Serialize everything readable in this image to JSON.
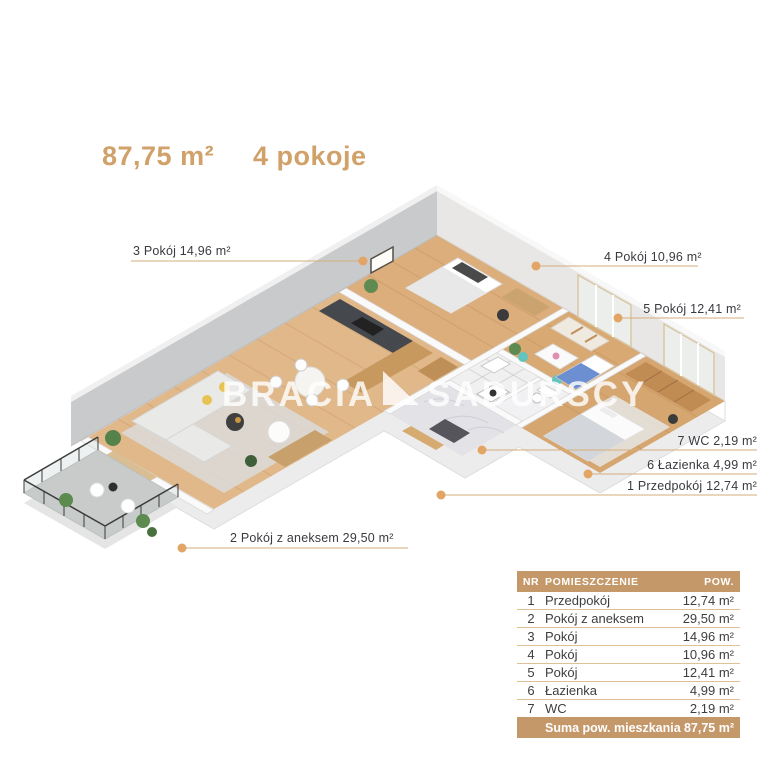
{
  "title": {
    "area": "87,75 m²",
    "rooms": "4 pokoje"
  },
  "watermark": {
    "left": "BRACIA",
    "right": "SADURSCY"
  },
  "plan_labels": {
    "room3": "3 Pokój 14,96 m²",
    "room4": "4 Pokój 10,96 m²",
    "room5": "5 Pokój 12,41 m²",
    "wc": "7 WC 2,19 m²",
    "bathroom": "6 Łazienka 4,99 m²",
    "hallway": "1 Przedpokój 12,74 m²",
    "room2": "2 Pokój z aneksem 29,50 m²"
  },
  "legend_table": {
    "headers": {
      "nr": "NR",
      "room": "POMIESZCZENIE",
      "area": "POW."
    },
    "rows": [
      {
        "nr": "1",
        "room": "Przedpokój",
        "area": "12,74 m²"
      },
      {
        "nr": "2",
        "room": "Pokój z aneksem",
        "area": "29,50 m²"
      },
      {
        "nr": "3",
        "room": "Pokój",
        "area": "14,96 m²"
      },
      {
        "nr": "4",
        "room": "Pokój",
        "area": "10,96 m²"
      },
      {
        "nr": "5",
        "room": "Pokój",
        "area": "12,41 m²"
      },
      {
        "nr": "6",
        "room": "Łazienka",
        "area": "4,99 m²"
      },
      {
        "nr": "7",
        "room": "WC",
        "area": "2,19 m²"
      }
    ],
    "footer": {
      "label": "Suma pow. mieszkania",
      "value": "87,75 m²"
    }
  },
  "colors": {
    "accent": "#d0a169",
    "table_header_bg": "#c5986a",
    "leader_line": "#d4ad7b",
    "leader_dot": "#e2a565"
  }
}
